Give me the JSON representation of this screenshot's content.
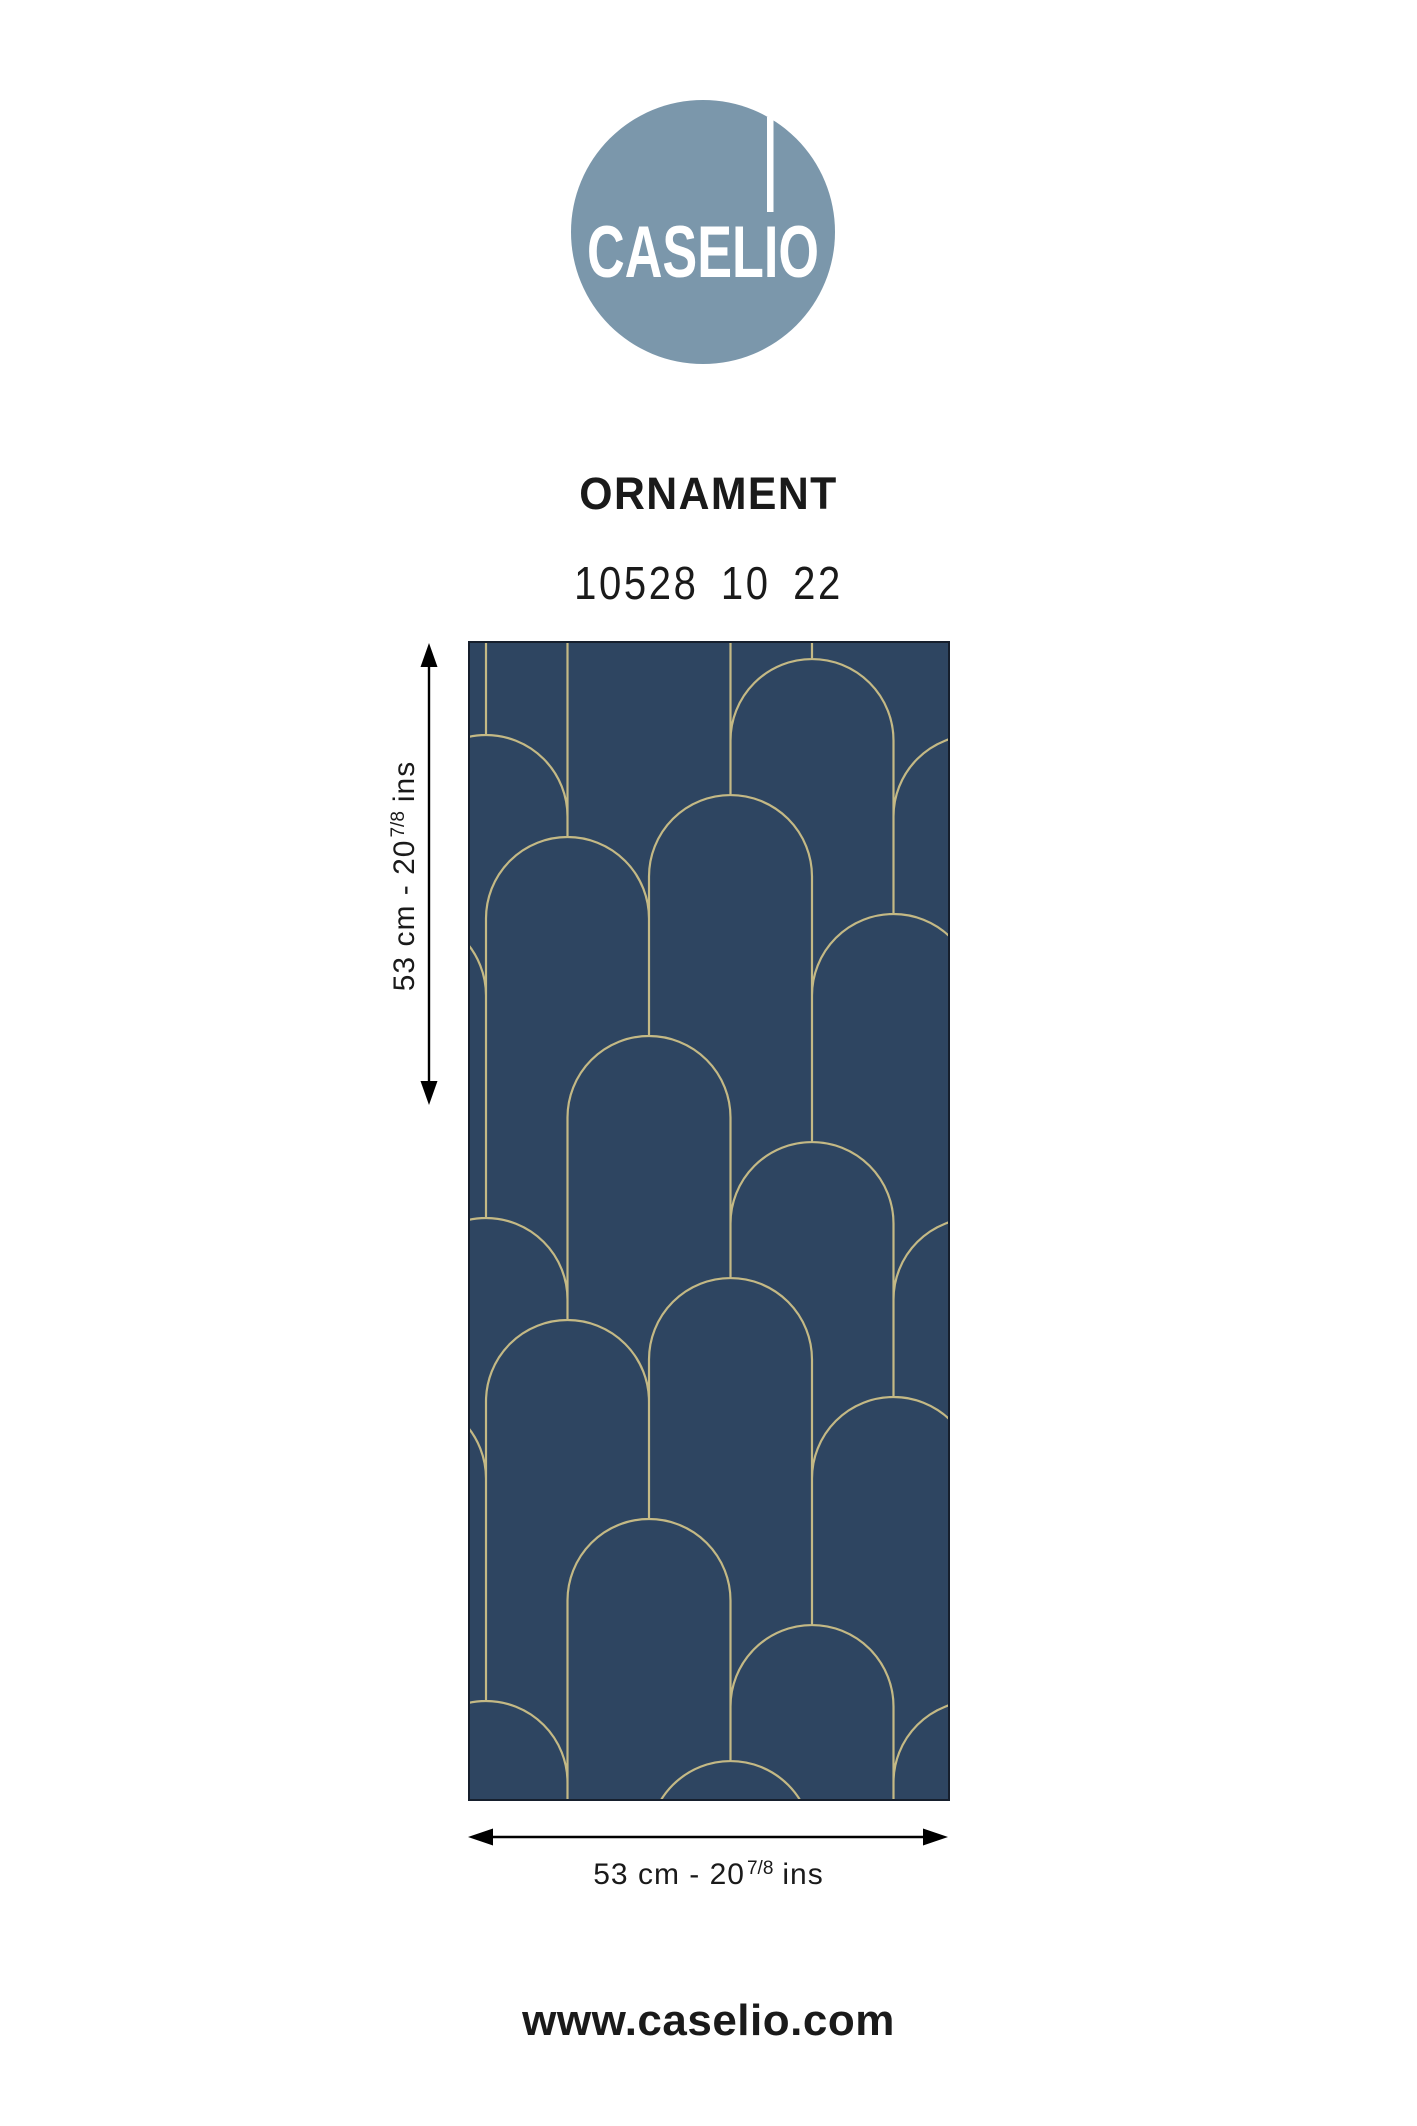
{
  "page": {
    "website": "www.caselio.com",
    "background_color": "#ffffff",
    "text_color": "#1a1a1a"
  },
  "logo": {
    "brand": "CASELIO",
    "circle_color": "#7b97ab",
    "letter_color": "#ffffff"
  },
  "product": {
    "name": "ORNAMENT",
    "reference": "10528 10 22"
  },
  "dimensions": {
    "width": {
      "prefix": "53 cm - 20",
      "sup": "7/8",
      "suffix": "ins"
    },
    "height": {
      "prefix": "53 cm - 20",
      "sup": "7/8",
      "suffix": "ins"
    },
    "arrow_color": "#000000"
  },
  "swatch": {
    "pattern_name": "art-deco-arches",
    "colors": {
      "background": "#2e4561",
      "line": "#c4b985",
      "border": "#161f2d"
    },
    "pattern": {
      "arch_radius": 81.5,
      "column_pitch": 81.5,
      "vertical_repeat": 483,
      "first_column_x": 18,
      "column_apex_offsets": [
        94,
        196,
        -88,
        154,
        18,
        273
      ],
      "stroke_width": 2.2
    }
  }
}
